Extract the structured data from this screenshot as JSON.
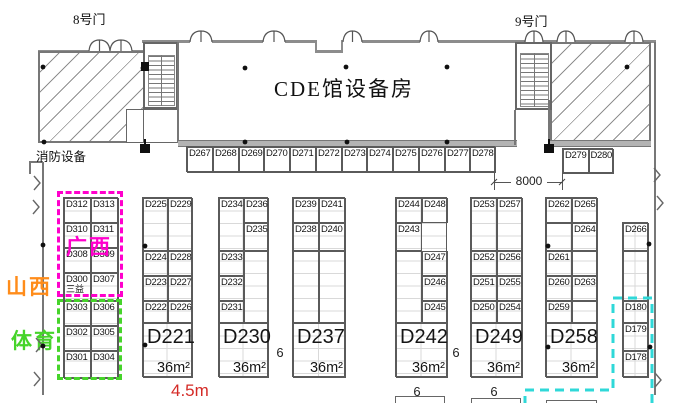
{
  "title": "CDE馆设备房",
  "gate8": "8号门",
  "gate9": "9号门",
  "fire_label": "消防设备",
  "regions": {
    "guangxi": "广西",
    "shanxi": "山西",
    "tiyu": "体育"
  },
  "dims": {
    "gate_width": "8000",
    "booth_width": "4.5m",
    "aisle1": "6",
    "aisle2": "6",
    "aisle3": "6",
    "aisle4": "6"
  },
  "colors": {
    "magenta": "#ff00cc",
    "orange": "#ff8c1a",
    "green": "#46d42a",
    "cyan": "#2fd8d8",
    "red": "#d42a26"
  },
  "blocks": [
    {
      "name": "booth-strip-top",
      "x": 186,
      "y": 146,
      "w": 309,
      "h": 26,
      "grid": false,
      "cells": [
        [
          "D267",
          0,
          0,
          26,
          26
        ],
        [
          "D268",
          26,
          0,
          26,
          26
        ],
        [
          "D269",
          52,
          0,
          25,
          26
        ],
        [
          "D270",
          77,
          0,
          26,
          26
        ],
        [
          "D271",
          103,
          0,
          26,
          26
        ],
        [
          "D272",
          129,
          0,
          26,
          26
        ],
        [
          "D273",
          155,
          0,
          25,
          26
        ],
        [
          "D274",
          180,
          0,
          26,
          26
        ],
        [
          "D275",
          206,
          0,
          26,
          26
        ],
        [
          "D276",
          232,
          0,
          26,
          26
        ],
        [
          "D277",
          258,
          0,
          25,
          26
        ],
        [
          "D278",
          283,
          0,
          26,
          26
        ]
      ]
    },
    {
      "name": "booth-strip-gate9",
      "x": 562,
      "y": 148,
      "w": 51,
      "h": 25,
      "grid": false,
      "cells": [
        [
          "D279",
          0,
          0,
          25.5,
          25
        ],
        [
          "D280",
          25.5,
          0,
          25.5,
          25
        ]
      ]
    },
    {
      "name": "block-guangxi-tiyu",
      "x": 63,
      "y": 197,
      "w": 55,
      "h": 181,
      "grid": true,
      "cells": [
        [
          "D312",
          0,
          0,
          27,
          25
        ],
        [
          "D313",
          27,
          0,
          28,
          25
        ],
        [
          "D310",
          0,
          25,
          27,
          25
        ],
        [
          "D311",
          27,
          25,
          28,
          25
        ],
        [
          "D308",
          0,
          50,
          27,
          25
        ],
        [
          "D309",
          27,
          50,
          28,
          25
        ],
        [
          "D300",
          0,
          75,
          27,
          28,
          {
            "sub": "三益"
          }
        ],
        [
          "D307",
          27,
          75,
          28,
          28
        ],
        [
          "D303",
          0,
          103,
          27,
          25
        ],
        [
          "D306",
          27,
          103,
          28,
          25
        ],
        [
          "D302",
          0,
          128,
          27,
          25
        ],
        [
          "D305",
          27,
          128,
          28,
          25
        ],
        [
          "D301",
          0,
          153,
          27,
          28
        ],
        [
          "D304",
          27,
          153,
          28,
          28
        ]
      ]
    },
    {
      "name": "block-d221",
      "x": 142,
      "y": 197,
      "w": 50,
      "h": 180,
      "grid": true,
      "cells": [
        [
          "D225",
          0,
          0,
          25,
          53
        ],
        [
          "D229",
          25,
          0,
          25,
          53
        ],
        [
          "D224",
          0,
          53,
          25,
          25
        ],
        [
          "D228",
          25,
          53,
          25,
          25
        ],
        [
          "D223",
          0,
          78,
          25,
          25
        ],
        [
          "D227",
          25,
          78,
          25,
          25
        ],
        [
          "D222",
          0,
          103,
          25,
          22
        ],
        [
          "D226",
          25,
          103,
          25,
          22
        ],
        [
          "D221",
          0,
          125,
          50,
          55,
          {
            "big": true,
            "area": "36m²"
          }
        ]
      ]
    },
    {
      "name": "block-d230",
      "x": 218,
      "y": 197,
      "w": 50,
      "h": 180,
      "grid": true,
      "cells": [
        [
          "D234",
          0,
          0,
          25,
          53
        ],
        [
          "D236",
          25,
          0,
          25,
          25
        ],
        [
          "D235",
          25,
          25,
          25,
          28
        ],
        [
          "D233",
          0,
          53,
          25,
          25
        ],
        [
          "",
          25,
          53,
          25,
          72
        ],
        [
          "D232",
          0,
          78,
          25,
          25
        ],
        [
          "D231",
          0,
          103,
          25,
          22
        ],
        [
          "D230",
          0,
          125,
          50,
          55,
          {
            "big": true,
            "area": "36m²"
          }
        ]
      ]
    },
    {
      "name": "block-d237",
      "x": 292,
      "y": 197,
      "w": 53,
      "h": 180,
      "grid": true,
      "cells": [
        [
          "D239",
          0,
          0,
          26,
          25
        ],
        [
          "D241",
          26,
          0,
          27,
          25
        ],
        [
          "D238",
          0,
          25,
          26,
          28
        ],
        [
          "D240",
          26,
          25,
          27,
          28
        ],
        [
          "",
          0,
          53,
          26,
          72
        ],
        [
          "",
          26,
          53,
          27,
          72
        ],
        [
          "D237",
          0,
          125,
          53,
          55,
          {
            "big": true,
            "area": "36m²"
          }
        ]
      ]
    },
    {
      "name": "block-d242",
      "x": 395,
      "y": 197,
      "w": 52,
      "h": 180,
      "grid": true,
      "cells": [
        [
          "D244",
          0,
          0,
          26,
          25
        ],
        [
          "D248",
          26,
          0,
          26,
          25
        ],
        [
          "D243",
          0,
          25,
          26,
          28
        ],
        [
          "",
          0,
          53,
          26,
          72
        ],
        [
          "D247",
          26,
          53,
          26,
          25
        ],
        [
          "D246",
          26,
          78,
          26,
          25
        ],
        [
          "D245",
          26,
          103,
          26,
          22
        ],
        [
          "D242",
          0,
          125,
          52,
          55,
          {
            "big": true,
            "area": "36m²"
          }
        ]
      ]
    },
    {
      "name": "block-d249",
      "x": 470,
      "y": 197,
      "w": 52,
      "h": 180,
      "grid": true,
      "cells": [
        [
          "D253",
          0,
          0,
          26,
          53
        ],
        [
          "D257",
          26,
          0,
          26,
          53
        ],
        [
          "D252",
          0,
          53,
          26,
          25
        ],
        [
          "D256",
          26,
          53,
          26,
          25
        ],
        [
          "D251",
          0,
          78,
          26,
          25
        ],
        [
          "D255",
          26,
          78,
          26,
          25
        ],
        [
          "D250",
          0,
          103,
          26,
          22
        ],
        [
          "D254",
          26,
          103,
          26,
          22
        ],
        [
          "D249",
          0,
          125,
          52,
          55,
          {
            "big": true,
            "area": "36m²"
          }
        ]
      ]
    },
    {
      "name": "block-d258",
      "x": 545,
      "y": 197,
      "w": 52,
      "h": 180,
      "grid": true,
      "cells": [
        [
          "D262",
          0,
          0,
          26,
          25
        ],
        [
          "D265",
          26,
          0,
          26,
          25
        ],
        [
          "",
          0,
          25,
          26,
          28
        ],
        [
          "D264",
          26,
          25,
          26,
          28
        ],
        [
          "D261",
          0,
          53,
          26,
          25
        ],
        [
          "",
          26,
          53,
          26,
          25
        ],
        [
          "D260",
          0,
          78,
          26,
          25
        ],
        [
          "D263",
          26,
          78,
          26,
          25
        ],
        [
          "D259",
          0,
          103,
          26,
          22
        ],
        [
          "",
          26,
          103,
          26,
          22
        ],
        [
          "D258",
          0,
          125,
          52,
          55,
          {
            "big": true,
            "area": "36m²"
          }
        ]
      ]
    },
    {
      "name": "block-right-column",
      "x": 622,
      "y": 222,
      "w": 26,
      "h": 155,
      "grid": true,
      "cells": [
        [
          "D266",
          0,
          0,
          26,
          28
        ],
        [
          "",
          0,
          28,
          26,
          50
        ],
        [
          "D180",
          0,
          78,
          26,
          22
        ],
        [
          "D179",
          0,
          100,
          26,
          28
        ],
        [
          "D178",
          0,
          128,
          26,
          27
        ]
      ]
    }
  ],
  "symbols": {
    "column_dots": [
      [
        43,
        67
      ],
      [
        143,
        68
      ],
      [
        245,
        68
      ],
      [
        346,
        67
      ],
      [
        447,
        67
      ],
      [
        627,
        67
      ],
      [
        44,
        142
      ],
      [
        245,
        142
      ],
      [
        347,
        142
      ],
      [
        447,
        142
      ],
      [
        43,
        245
      ],
      [
        145,
        246
      ],
      [
        145,
        345
      ],
      [
        43,
        346
      ],
      [
        548,
        246
      ],
      [
        548,
        347
      ],
      [
        649,
        244
      ],
      [
        650,
        347
      ]
    ],
    "black_markers": [
      [
        140,
        144,
        10,
        9
      ],
      [
        144,
        139,
        2,
        5
      ],
      [
        544,
        144,
        10,
        9
      ],
      [
        548,
        139,
        2,
        5
      ],
      [
        141,
        62,
        8,
        9
      ]
    ],
    "door_arcs": [
      {
        "x": 89,
        "w": 21,
        "y": 51
      },
      {
        "x": 110,
        "w": 22,
        "y": 51
      },
      {
        "x": 190,
        "w": 22,
        "y": 42
      },
      {
        "x": 263,
        "w": 22,
        "y": 42
      },
      {
        "x": 343,
        "w": 19,
        "y": 42
      },
      {
        "x": 420,
        "w": 18,
        "y": 42
      },
      {
        "x": 525,
        "w": 18,
        "y": 42
      },
      {
        "x": 557,
        "w": 18,
        "y": 42
      },
      {
        "x": 625,
        "w": 18,
        "y": 42
      }
    ],
    "wall_breaks": [
      [
        34,
        176
      ],
      [
        33,
        200
      ],
      [
        36,
        338
      ],
      [
        34,
        372
      ],
      [
        654,
        168
      ],
      [
        657,
        196
      ],
      [
        655,
        373
      ]
    ],
    "dim_ticks": [
      [
        494,
        182
      ],
      [
        562,
        182
      ]
    ],
    "highlight_path": "M525,405 L525,390 L613,390 L613,298 L652,298 L652,405"
  }
}
